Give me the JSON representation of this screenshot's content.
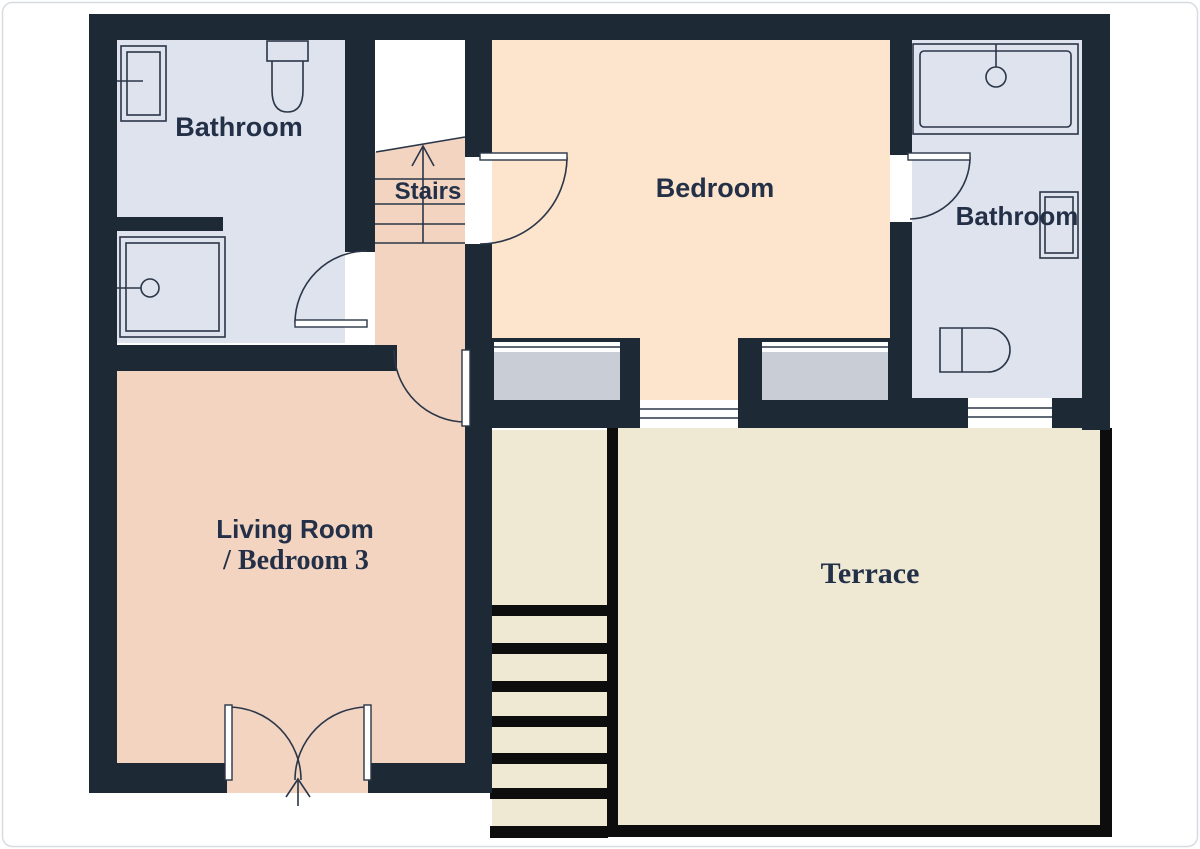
{
  "floorplan": {
    "title": "First floor plan",
    "rooms": {
      "bathroom_top_left": {
        "label": "Bathroom"
      },
      "stairs": {
        "label": "Stairs"
      },
      "bedroom": {
        "label": "Bedroom"
      },
      "bathroom_right": {
        "label": "Bathroom"
      },
      "living_room": {
        "label_line1": "Living Room",
        "label_line2": "/ Bedroom 3"
      },
      "terrace": {
        "label": "Terrace"
      }
    },
    "icons": {
      "stairs_up_arrow": "arrow-up-icon",
      "entrance_arrow": "arrow-up-icon"
    },
    "fixtures": {
      "bathroom_top_left": [
        "sink",
        "toilet",
        "shower"
      ],
      "bathroom_right": [
        "bathtub",
        "sink",
        "toilet"
      ]
    },
    "colors": {
      "wall": "#1e2936",
      "bathroom_floor": "#dee3ee",
      "bedroom_floor": "#fce5cc",
      "living_floor": "#f2d4c1",
      "terrace_floor": "#efe9d4",
      "window_sill": "#c9cdd5",
      "stair_black": "#0d0d0d",
      "label_text": "#233047",
      "page_border": "#d8dce1"
    }
  }
}
